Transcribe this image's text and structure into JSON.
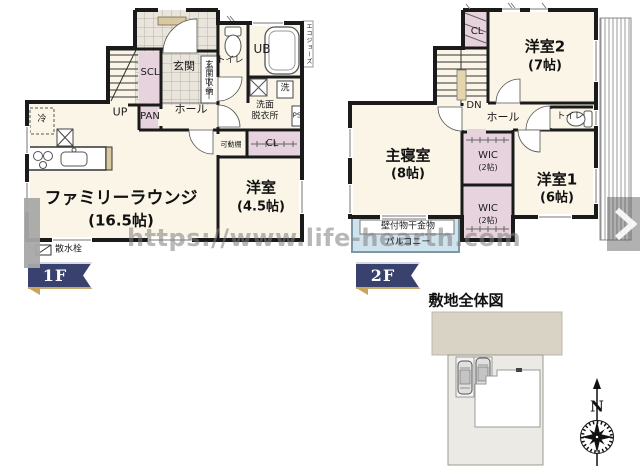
{
  "watermark": "https://www.life-hearth.com",
  "floor1": {
    "badge": "1F",
    "family_lounge_name": "ファミリーラウンジ",
    "family_lounge_size": "(16.5帖)",
    "yoshitsu_name": "洋室",
    "yoshitsu_size": "(4.5帖)",
    "hall": "ホール",
    "genkan": "玄関",
    "genkan_storage": "玄関収納",
    "scl": "SCL",
    "pan": "PAN",
    "up": "UP",
    "toilet": "トイレ",
    "ub": "UB",
    "washroom_line1": "洗面",
    "washroom_line2": "脱衣所",
    "laundry": "洗",
    "ps": "PS",
    "cl": "CL",
    "movable_shelf": "可動棚",
    "fridge": "冷",
    "water_heater": "エコジョーズ",
    "sprinkler": "散水栓"
  },
  "floor2": {
    "badge": "2F",
    "master_name": "主寝室",
    "master_size": "(8帖)",
    "yoshitsu1_name": "洋室1",
    "yoshitsu1_size": "(6帖)",
    "yoshitsu2_name": "洋室2",
    "yoshitsu2_size": "(7帖)",
    "wic1_name": "WIC",
    "wic1_size": "(2帖)",
    "wic2_name": "WIC",
    "wic2_size": "(2帖)",
    "hall": "ホール",
    "toilet": "トイレ",
    "dn": "DN",
    "cl": "CL",
    "hanger": "壁付物干金物",
    "balcony": "バルコニー"
  },
  "site": {
    "title": "敷地全体図",
    "compass_north": "N"
  },
  "colors": {
    "wall": "#1a1a1a",
    "floor": "#faf5e6",
    "closet_pink": "#e7d3de",
    "balcony_blue": "#cfe3ee",
    "tile_gray": "#e9e5dc",
    "road_beige": "#d8d3c5",
    "plot_gray": "#eceae4",
    "badge_navy": "#39416e",
    "badge_gold": "#c9a45c",
    "watermark_gray": "#7d7d7d"
  }
}
